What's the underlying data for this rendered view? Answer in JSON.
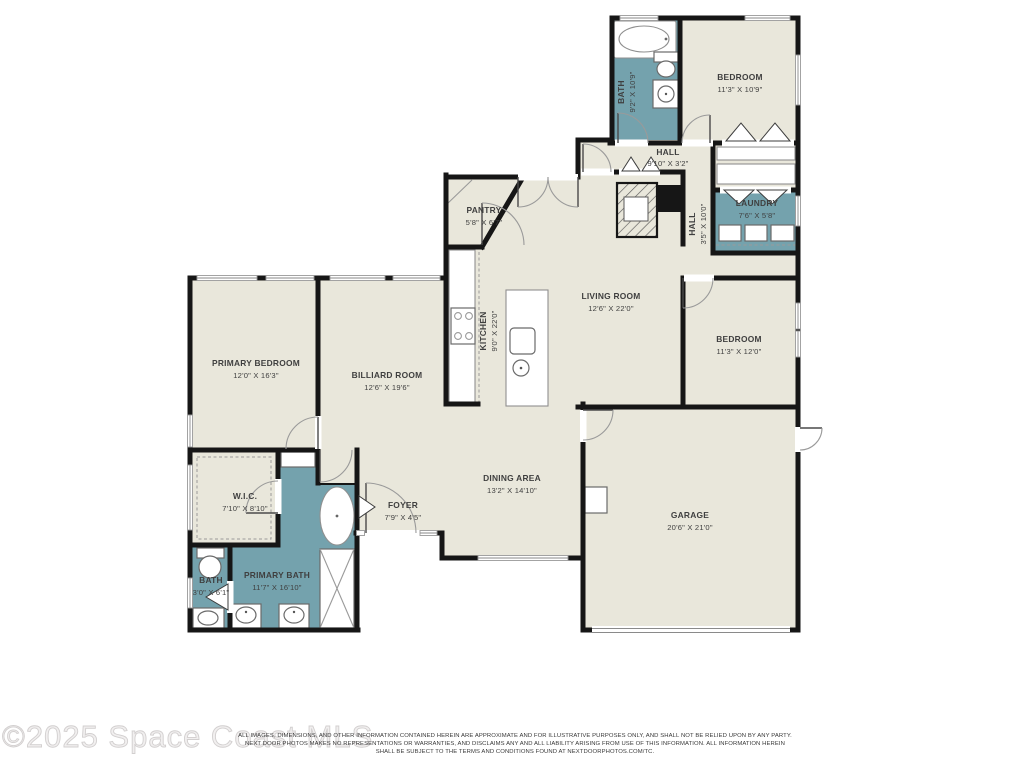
{
  "watermark": "©2025 Space Coast MLS",
  "disclaimer": {
    "line1": "ALL IMAGES, DIMENSIONS, AND OTHER INFORMATION CONTAINED HEREIN ARE APPROXIMATE AND FOR ILLUSTRATIVE PURPOSES ONLY, AND SHALL NOT BE RELIED UPON BY ANY PARTY.",
    "line2": "NEXT DOOR PHOTOS MAKES NO REPRESENTATIONS OR WARRANTIES, AND DISCLAIMS ANY AND ALL LIABILITY ARISING FROM USE OF THIS INFORMATION. ALL INFORMATION HEREIN",
    "line3": "SHALL BE SUBJECT TO THE TERMS AND CONDITIONS FOUND AT NEXTDOORPHOTOS.COM/TC."
  },
  "colors": {
    "room_fill": "#e9e7db",
    "wet_room_fill": "#74a2ad",
    "wall": "#161616",
    "label": "#3f3f3f"
  },
  "rooms": {
    "bath_top": {
      "name": "BATH",
      "dims": "9'2\" X 10'9\""
    },
    "bedroom_top": {
      "name": "BEDROOM",
      "dims": "11'3\" X 10'9\""
    },
    "hall_top": {
      "name": "HALL",
      "dims": "9'10\" X 3'2\""
    },
    "laundry": {
      "name": "LAUNDRY",
      "dims": "7'6\" X 5'8\""
    },
    "hall_vertical": {
      "name": "HALL",
      "dims": "3'5\" X 10'0\""
    },
    "pantry": {
      "name": "PANTRY",
      "dims": "5'8\" X 6'7\""
    },
    "living_room": {
      "name": "LIVING ROOM",
      "dims": "12'6\" X 22'0\""
    },
    "kitchen": {
      "name": "KITCHEN",
      "dims": "9'0\" X 22'0\""
    },
    "bedroom_right": {
      "name": "BEDROOM",
      "dims": "11'3\" X 12'0\""
    },
    "primary_bedroom": {
      "name": "PRIMARY BEDROOM",
      "dims": "12'0\" X 16'3\""
    },
    "billiard_room": {
      "name": "BILLIARD ROOM",
      "dims": "12'6\" X 19'6\""
    },
    "dining_area": {
      "name": "DINING AREA",
      "dims": "13'2\" X 14'10\""
    },
    "foyer": {
      "name": "FOYER",
      "dims": "7'9\" X 4'5\""
    },
    "wic": {
      "name": "W.I.C.",
      "dims": "7'10\" X 8'10\""
    },
    "garage": {
      "name": "GARAGE",
      "dims": "20'6\" X 21'0\""
    },
    "bath_small": {
      "name": "BATH",
      "dims": "3'0\" X 6'1\""
    },
    "primary_bath": {
      "name": "PRIMARY BATH",
      "dims": "11'7\" X 16'10\""
    }
  }
}
